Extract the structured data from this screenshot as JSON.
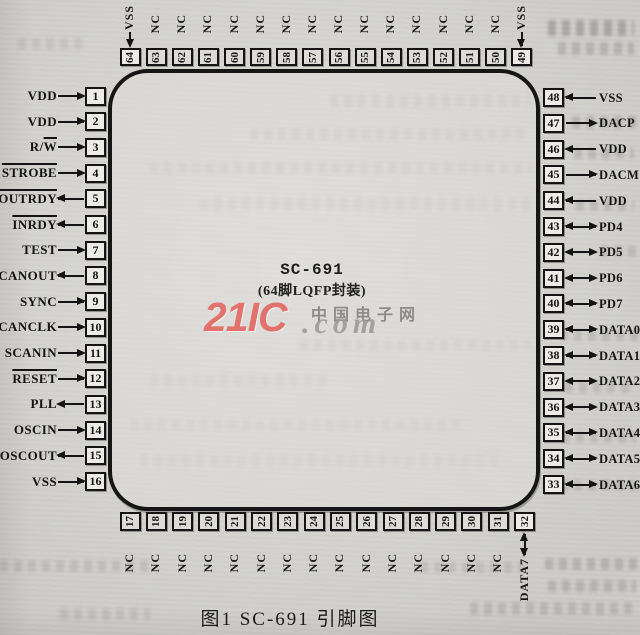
{
  "figure": {
    "chip_title": "SC-691",
    "chip_subtitle": "(64脚LQFP封装)",
    "caption": "图1  SC-691 引脚图"
  },
  "watermark": {
    "brand": "21IC",
    "site": "中国电子网",
    "domain": ".com",
    "brand_color": "#e0736b"
  },
  "pins": {
    "left": [
      {
        "n": 1,
        "text": "VDD",
        "dir": "in"
      },
      {
        "n": 2,
        "text": "VDD",
        "dir": "in"
      },
      {
        "n": 3,
        "text": "R/W",
        "dir": "in",
        "over": "W"
      },
      {
        "n": 4,
        "text": "STROBE",
        "dir": "in",
        "over": "STROBE"
      },
      {
        "n": 5,
        "text": "OUTRDY",
        "dir": "out",
        "over": "OUTRDY"
      },
      {
        "n": 6,
        "text": "INRDY",
        "dir": "out",
        "over": "INRDY"
      },
      {
        "n": 7,
        "text": "TEST",
        "dir": "in"
      },
      {
        "n": 8,
        "text": "SCANOUT",
        "dir": "out"
      },
      {
        "n": 9,
        "text": "SYNC",
        "dir": "in"
      },
      {
        "n": 10,
        "text": "SCANCLK",
        "dir": "in"
      },
      {
        "n": 11,
        "text": "SCANIN",
        "dir": "in"
      },
      {
        "n": 12,
        "text": "RESET",
        "dir": "in",
        "over": "RESET"
      },
      {
        "n": 13,
        "text": "PLL",
        "dir": "out"
      },
      {
        "n": 14,
        "text": "OSCIN",
        "dir": "in"
      },
      {
        "n": 15,
        "text": "OSCOUT",
        "dir": "out"
      },
      {
        "n": 16,
        "text": "VSS",
        "dir": "in"
      }
    ],
    "right": [
      {
        "n": 48,
        "text": "VSS",
        "dir": "in"
      },
      {
        "n": 47,
        "text": "DACP",
        "dir": "out"
      },
      {
        "n": 46,
        "text": "VDD",
        "dir": "in"
      },
      {
        "n": 45,
        "text": "DACM",
        "dir": "out"
      },
      {
        "n": 44,
        "text": "VDD",
        "dir": "in"
      },
      {
        "n": 43,
        "text": "PD4",
        "dir": "bi"
      },
      {
        "n": 42,
        "text": "PD5",
        "dir": "bi"
      },
      {
        "n": 41,
        "text": "PD6",
        "dir": "bi"
      },
      {
        "n": 40,
        "text": "PD7",
        "dir": "bi"
      },
      {
        "n": 39,
        "text": "DATA0",
        "dir": "bi"
      },
      {
        "n": 38,
        "text": "DATA1",
        "dir": "bi"
      },
      {
        "n": 37,
        "text": "DATA2",
        "dir": "bi"
      },
      {
        "n": 36,
        "text": "DATA3",
        "dir": "bi"
      },
      {
        "n": 35,
        "text": "DATA4",
        "dir": "bi"
      },
      {
        "n": 34,
        "text": "DATA5",
        "dir": "bi"
      },
      {
        "n": 33,
        "text": "DATA6",
        "dir": "bi"
      }
    ],
    "top": [
      {
        "n": 64,
        "text": "VSS",
        "dir": "in"
      },
      {
        "n": 63,
        "text": "NC",
        "dir": "nc"
      },
      {
        "n": 62,
        "text": "NC",
        "dir": "nc"
      },
      {
        "n": 61,
        "text": "NC",
        "dir": "nc"
      },
      {
        "n": 60,
        "text": "NC",
        "dir": "nc"
      },
      {
        "n": 59,
        "text": "NC",
        "dir": "nc"
      },
      {
        "n": 58,
        "text": "NC",
        "dir": "nc"
      },
      {
        "n": 57,
        "text": "NC",
        "dir": "nc"
      },
      {
        "n": 56,
        "text": "NC",
        "dir": "nc"
      },
      {
        "n": 55,
        "text": "NC",
        "dir": "nc"
      },
      {
        "n": 54,
        "text": "NC",
        "dir": "nc"
      },
      {
        "n": 53,
        "text": "NC",
        "dir": "nc"
      },
      {
        "n": 52,
        "text": "NC",
        "dir": "nc"
      },
      {
        "n": 51,
        "text": "NC",
        "dir": "nc"
      },
      {
        "n": 50,
        "text": "NC",
        "dir": "nc"
      },
      {
        "n": 49,
        "text": "VSS",
        "dir": "in"
      }
    ],
    "bottom": [
      {
        "n": 17,
        "text": "NC",
        "dir": "nc"
      },
      {
        "n": 18,
        "text": "NC",
        "dir": "nc"
      },
      {
        "n": 19,
        "text": "NC",
        "dir": "nc"
      },
      {
        "n": 20,
        "text": "NC",
        "dir": "nc"
      },
      {
        "n": 21,
        "text": "NC",
        "dir": "nc"
      },
      {
        "n": 22,
        "text": "NC",
        "dir": "nc"
      },
      {
        "n": 23,
        "text": "NC",
        "dir": "nc"
      },
      {
        "n": 24,
        "text": "NC",
        "dir": "nc"
      },
      {
        "n": 25,
        "text": "NC",
        "dir": "nc"
      },
      {
        "n": 26,
        "text": "NC",
        "dir": "nc"
      },
      {
        "n": 27,
        "text": "NC",
        "dir": "nc"
      },
      {
        "n": 28,
        "text": "NC",
        "dir": "nc"
      },
      {
        "n": 29,
        "text": "NC",
        "dir": "nc"
      },
      {
        "n": 30,
        "text": "NC",
        "dir": "nc"
      },
      {
        "n": 31,
        "text": "NC",
        "dir": "nc"
      },
      {
        "n": 32,
        "text": "DATA7",
        "dir": "bi"
      }
    ]
  }
}
